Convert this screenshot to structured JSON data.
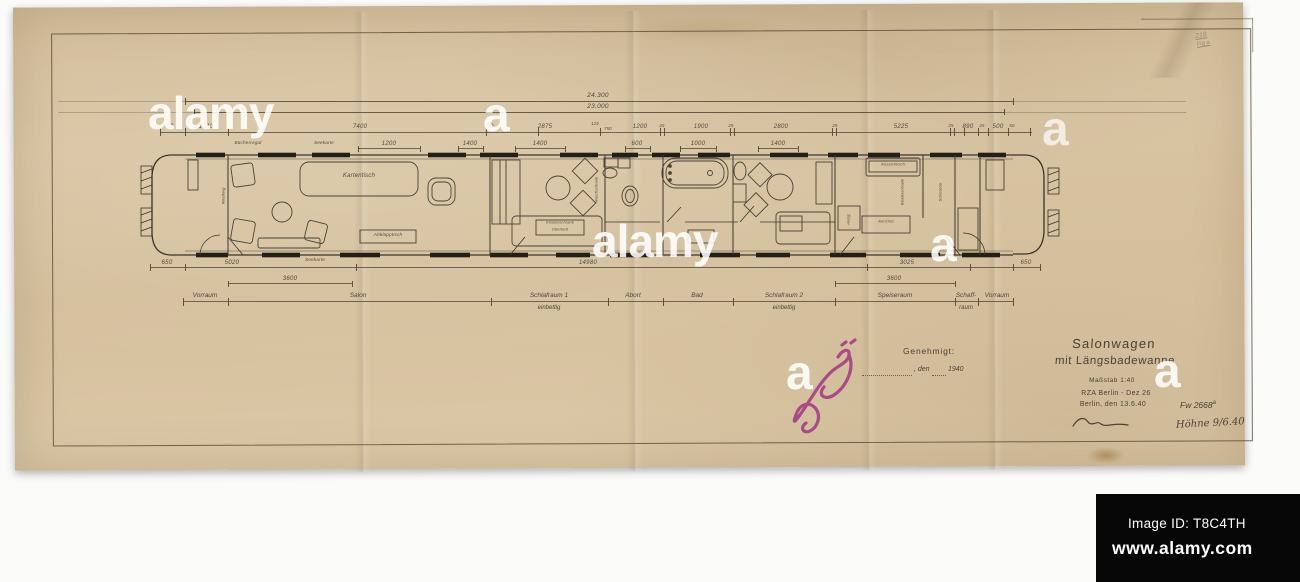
{
  "alamy": {
    "wordmark": "alamy",
    "mark": "a",
    "image_id": "Image ID: T8C4TH",
    "site": "www.alamy.com"
  },
  "pencil_note": {
    "line1": "218",
    "line2": "Fig a"
  },
  "title_block": {
    "line1": "Salonwagen",
    "line2": "mit Längsbadewanne",
    "scale": "Maßstab 1:40",
    "office": "RZA Berlin - Dez 26",
    "place_date": "Berlin, den 13.6.40",
    "drawing_no": "Fw 2668",
    "drawing_no_sup": "a",
    "examiner": "Höhne 9/6.40"
  },
  "approval": {
    "label": "Genehmigt:",
    "den": ", den",
    "year": "1940"
  },
  "dims": {
    "total": "24.300",
    "inner": "23.000",
    "chain": [
      "50",
      "1240",
      "7400",
      "50",
      "2875",
      "125",
      "750",
      "1200",
      "25",
      "1900",
      "25",
      "2800",
      "25",
      "5225",
      "25",
      "890",
      "25",
      "500",
      "50"
    ],
    "sub": [
      "1200",
      "1400",
      "1400",
      "600",
      "1000",
      "1400"
    ],
    "bottom": [
      "650",
      "5020",
      "14980",
      "3025",
      "650"
    ],
    "lower_left": "3600",
    "lower_right": "3600"
  },
  "rooms": [
    {
      "label": "Vorraum",
      "sub": ""
    },
    {
      "label": "Salon",
      "sub": ""
    },
    {
      "label": "Schlafraum 1",
      "sub": "einbettig"
    },
    {
      "label": "Abort",
      "sub": ""
    },
    {
      "label": "Bad",
      "sub": ""
    },
    {
      "label": "Schlafraum 2",
      "sub": "einbettig"
    },
    {
      "label": "Speiseraum",
      "sub": ""
    },
    {
      "label": "Schaff-",
      "sub": "raum"
    },
    {
      "label": "Vorraum",
      "sub": ""
    }
  ],
  "plan_labels": {
    "buecherregal": "Bücherregal",
    "seekarte_top": "Seekarte",
    "kartentisch": "Kartentisch",
    "seekarte_bottom": "Seekarte",
    "abklapptisch": "Abklapptisch",
    "schrank1a": "Kleiderschrank",
    "schrank1b": "Oberbett",
    "waschschrank": "Waschschrank",
    "ausziehtisch": "Ausziehtisch",
    "anrichte": "Anrichte",
    "heizg": "Heizg.",
    "kleiderschrank2": "Kleiderschrank",
    "schiebetuer": "Schiebetür",
    "windfang": "Windfang"
  }
}
